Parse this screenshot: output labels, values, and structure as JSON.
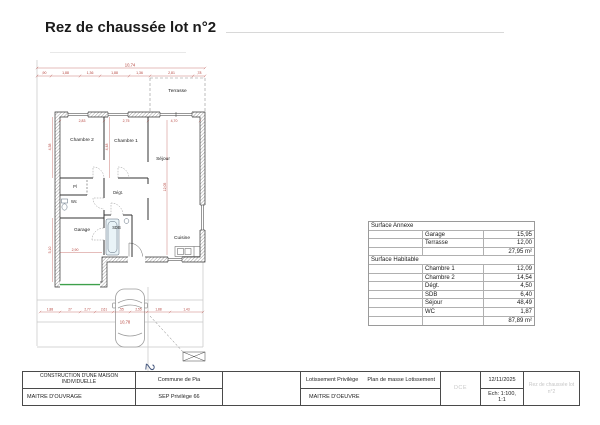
{
  "page": {
    "title": "Rez de chaussée lot n°2"
  },
  "plan": {
    "rooms": {
      "terrasse": "Terrasse",
      "chambre2": "Chambre 2",
      "chambre1": "Chambre 1",
      "sejour": "Séjour",
      "pl": "Pl",
      "wc": "Wc",
      "degt": "Dégt.",
      "garage": "Garage",
      "sdb": "SDB",
      "cuisine": "Cuisine"
    },
    "dims": {
      "top_total": "10,74",
      "top_segments": [
        ",90",
        "1,88",
        "1,36",
        "1,88",
        "1,36",
        "2,81",
        ",78"
      ],
      "room_widths": [
        "2,83",
        "2,75",
        "4,70"
      ],
      "left_upper": "4,38",
      "left_lower": "5,10",
      "mid_vertical": "4,48",
      "sejour_vertical": "12,05",
      "garage_width": "2,90",
      "drive_segments": [
        "1,88",
        "27",
        "2,77",
        "2,61",
        ",55",
        "2,55",
        "1,88",
        "1,43"
      ],
      "drive_total": "10,78"
    },
    "mark": "2"
  },
  "surfaces": {
    "section1": "Surface Annexe",
    "rows1": [
      {
        "label": "Garage",
        "value": "15,95"
      },
      {
        "label": "Terrasse",
        "value": "12,00"
      }
    ],
    "total1": "27,95 m²",
    "section2": "Surface Habitable",
    "rows2": [
      {
        "label": "Chambre 1",
        "value": "12,09"
      },
      {
        "label": "Chambre 2",
        "value": "14,54"
      },
      {
        "label": "Dégt.",
        "value": "4,50"
      },
      {
        "label": "SDB",
        "value": "6,40"
      },
      {
        "label": "Séjour",
        "value": "48,49"
      },
      {
        "label": "WC",
        "value": "1,87"
      }
    ],
    "total2": "87,89 m²"
  },
  "titleblock": {
    "project_line": "CONSTRUCTION D'UNE MAISON INDIVIDUELLE",
    "owner_role": "MAITRE D'OUVRAGE",
    "commune": "Commune de Pia",
    "company": "SEP Privilège 66",
    "lotissement": "Lotissement Privilège",
    "plan_title": "Plan de masse Lotissement",
    "architect_role": "MAITRE D'OEUVRE",
    "phase": "DCE",
    "date": "12/11/2025",
    "scale": "Ech: 1:100, 1:1",
    "sheet_name": "Rez de chaussée lot n°2"
  }
}
